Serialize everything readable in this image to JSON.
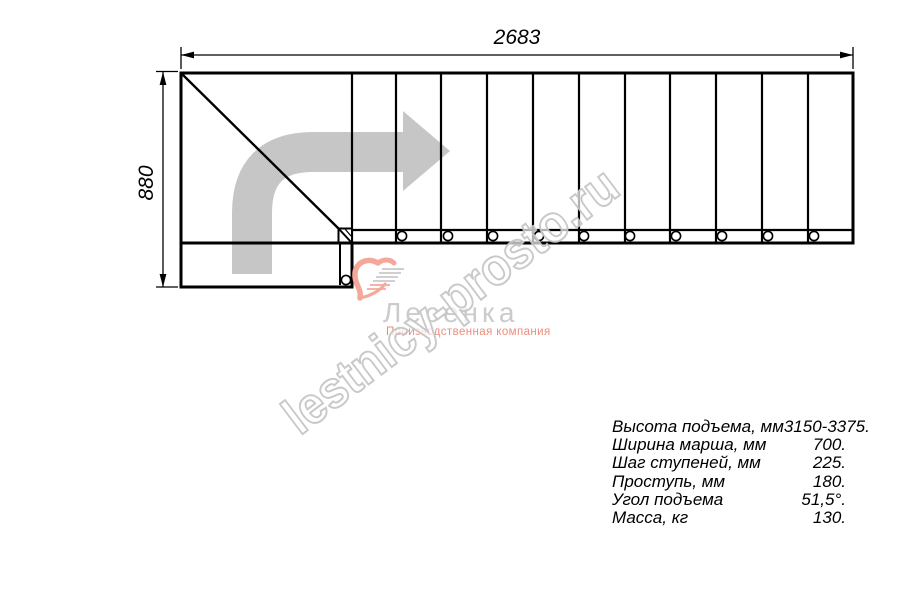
{
  "drawing": {
    "width_dim_label": "2683",
    "height_dim_label": "880"
  },
  "watermark": {
    "text": "lestnicy-prosto.ru"
  },
  "logo": {
    "name": "Лесенка",
    "tagline": "Производственная компания"
  },
  "specs": {
    "rows": [
      {
        "label": "Высота подъема, мм",
        "value": "3150-3375."
      },
      {
        "label": "Ширина марша, мм",
        "value": "700."
      },
      {
        "label": "Шаг ступеней, мм",
        "value": "225."
      },
      {
        "label": "Проступь, мм",
        "value": "180."
      },
      {
        "label": "Угол подъема",
        "value": "51,5°."
      },
      {
        "label": "Масса, кг",
        "value": "130."
      }
    ]
  },
  "colors": {
    "line": "#000000",
    "arrow_gray": "#c6c6c6",
    "watermark_gray": "#c7c7c7",
    "logo_gray": "#cbcbcb",
    "logo_pink": "#f5a79a",
    "tagline_pink": "#ee8c7c"
  }
}
